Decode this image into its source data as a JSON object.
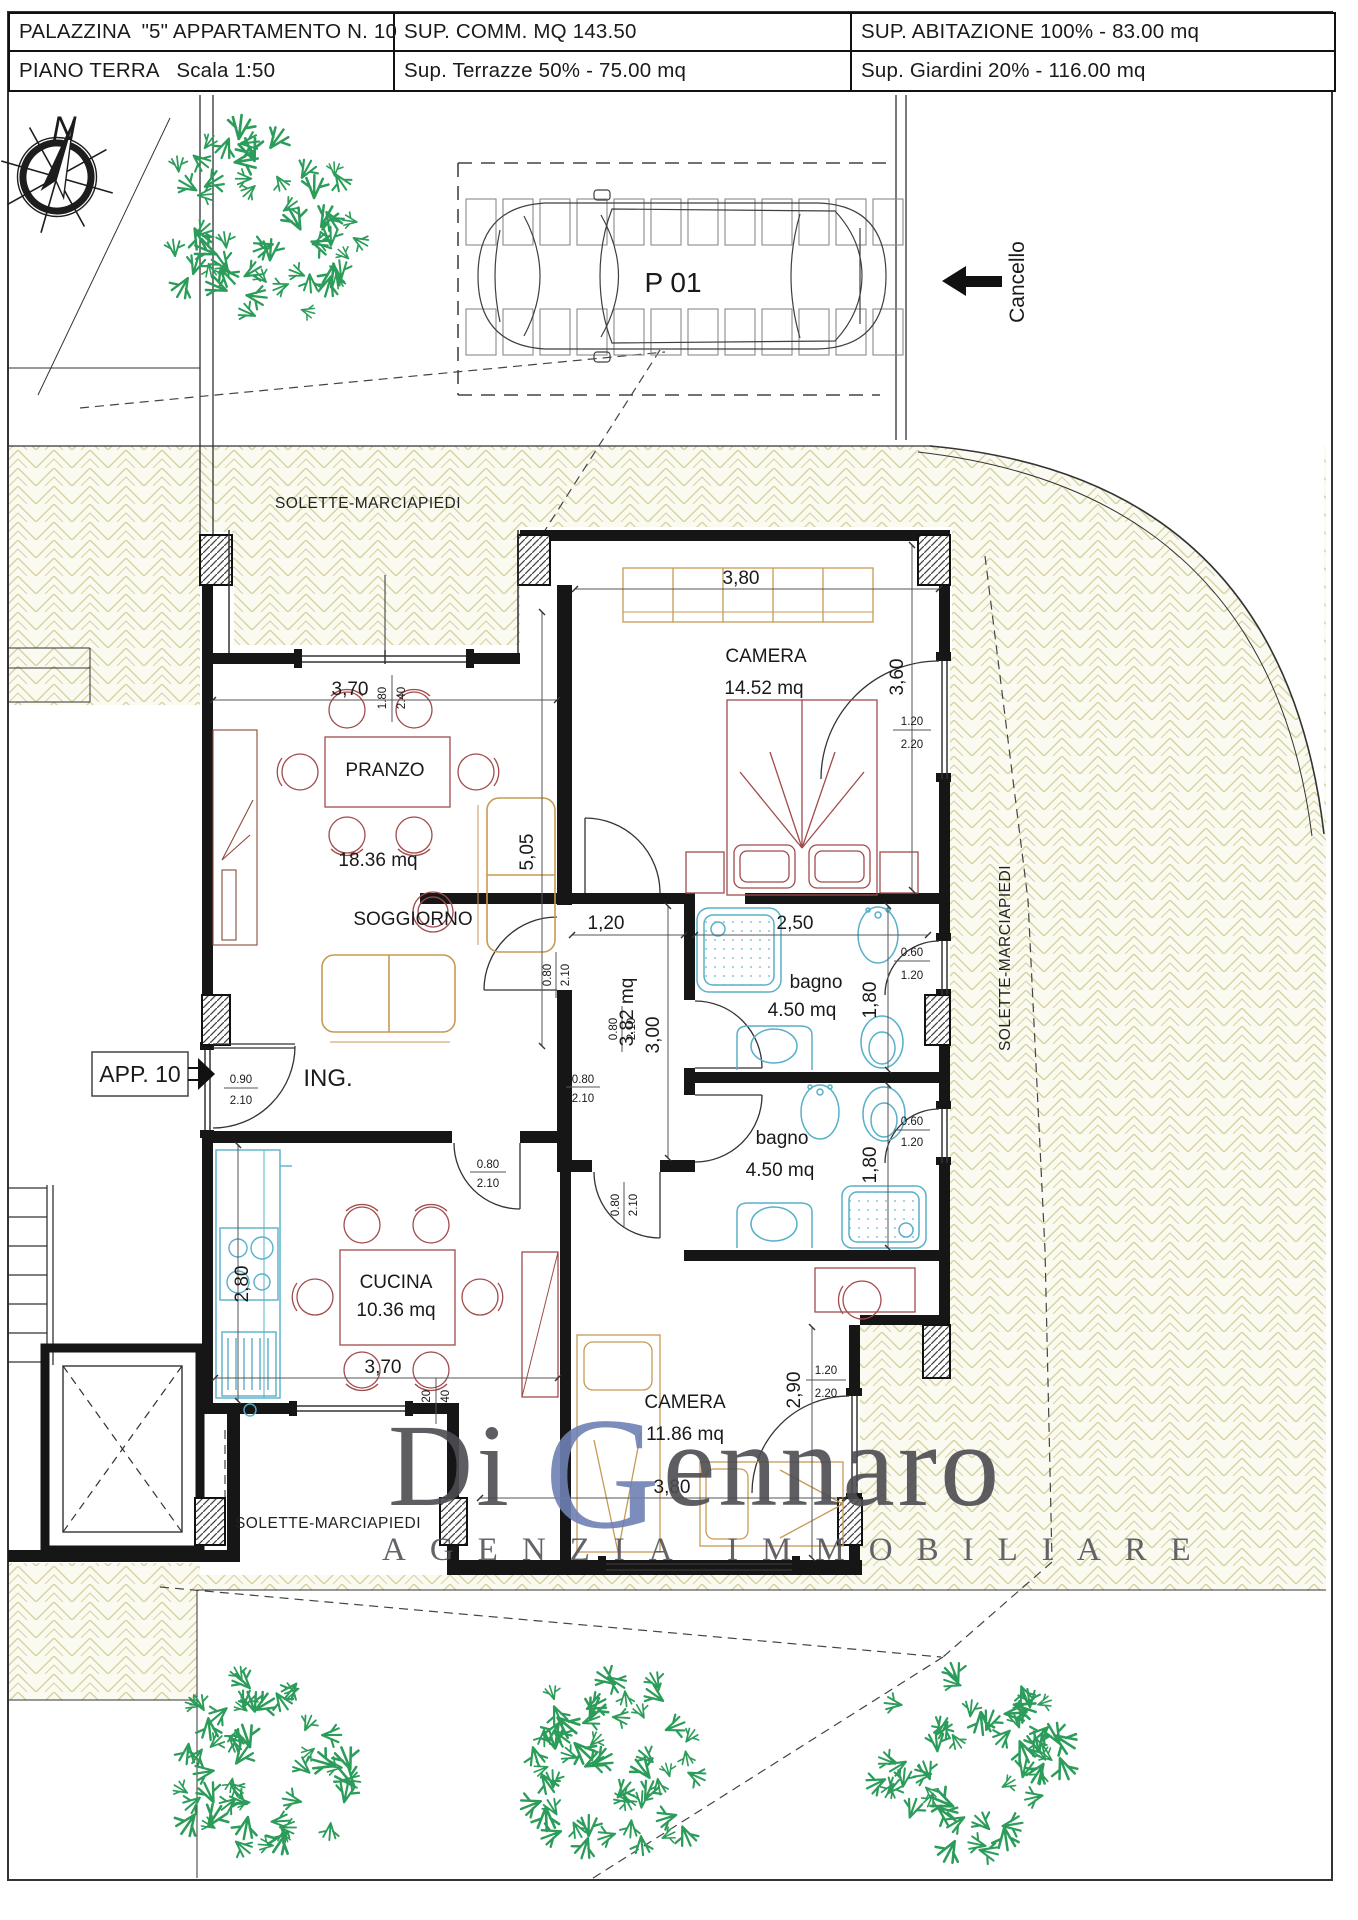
{
  "header": {
    "row1": [
      "PALAZZINA  \"5\" APPARTAMENTO N. 10",
      "SUP. COMM. MQ 143.50",
      "SUP. ABITAZIONE 100% - 83.00 mq"
    ],
    "row2": [
      "PIANO TERRA   Scala 1:50",
      "Sup. Terrazze 50% - 75.00 mq",
      "Sup. Giardini 20% - 116.00 mq"
    ]
  },
  "site": {
    "north": "N",
    "parking_space": "P 01",
    "gate": "Cancello",
    "sidewalk_top": "SOLETTE-MARCIAPIEDI",
    "sidewalk_right": "SOLETTE-MARCIAPIEDI",
    "sidewalk_bottom": "SOLETTE-MARCIAPIEDI"
  },
  "apartment": {
    "badge": "APP. 10",
    "entrance": "ING.",
    "rooms": {
      "pranzo": {
        "name": "PRANZO",
        "area": "18.36 mq"
      },
      "soggiorno": {
        "name": "SOGGIORNO"
      },
      "camera1": {
        "name": "CAMERA",
        "area": "14.52 mq"
      },
      "bagno1": {
        "name": "bagno",
        "area": "4.50 mq"
      },
      "bagno2": {
        "name": "bagno",
        "area": "4.50 mq"
      },
      "cucina": {
        "name": "CUCINA",
        "area": "10.36 mq"
      },
      "camera2": {
        "name": "CAMERA",
        "area": "11.86 mq"
      },
      "disimpegno": {
        "area": "3.82 mq"
      }
    }
  },
  "dims": {
    "d370": "3,70",
    "d380": "3,80",
    "d360": "3,60",
    "d505": "5,05",
    "d120": "1,20",
    "d250": "2,50",
    "d180": "1,80",
    "d300": "3,00",
    "d280": "2,80",
    "d290": "2,90"
  },
  "fractions": {
    "f090": "0.90",
    "f210": "2.10",
    "f080": "0.80",
    "f060": "0.60",
    "f120": "1.20",
    "f220": "2.20",
    "f180": "1.80",
    "f240": "2.40"
  },
  "watermark": {
    "p1": "Di",
    "p2": "G",
    "p3": "ennaro",
    "tagline": "AGENZIA IMMOBILIARE"
  },
  "colors": {
    "wall": "#161616",
    "hatch_line": "#d6d2a0",
    "fixture": "#58b0c9",
    "furniture_warm": "#c79a55",
    "furniture_red": "#a04b4b",
    "tree": "#2b9c59",
    "watermark_text": "#4c4c52",
    "watermark_accent": "#6e80b4"
  }
}
